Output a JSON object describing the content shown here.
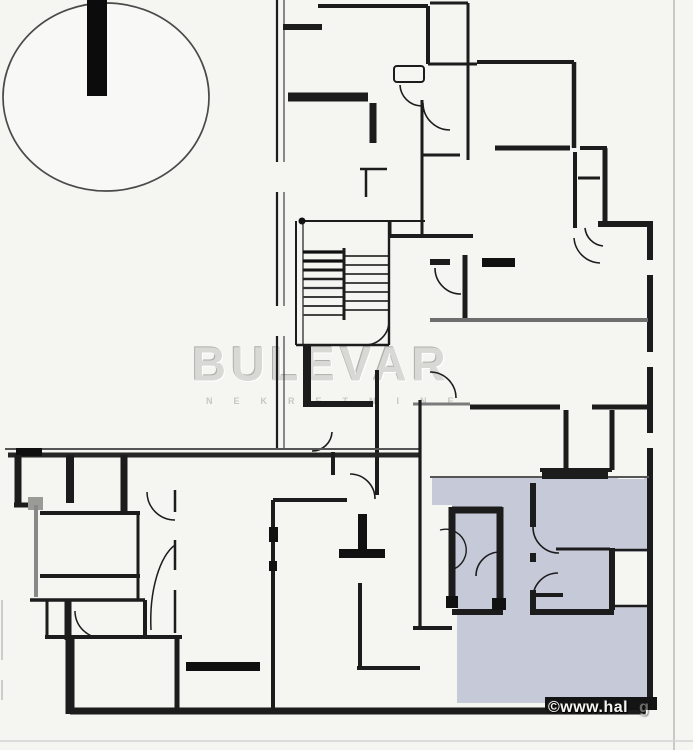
{
  "image": {
    "description": "Building floor plan with one apartment highlighted",
    "watermarks": {
      "brand": "BULEVAR",
      "brand_subtitle": "NEKRETNINE",
      "copyright": "©www.hal",
      "copyright_faint": "g"
    },
    "colors": {
      "background": "#f5f5f2",
      "wall": "#1c1c1c",
      "muted_wall": "#6e6e6e",
      "highlight_fill": "#c6c9d8",
      "brand_watermark": "#d8d8d4",
      "copyright_text": "#f4f4f2"
    },
    "elements": {
      "north_indicator": "circle with thick vertical bar, top-left",
      "stairwell": "hatched stair treads, center of plan",
      "highlighted_unit": "lavender apartment, bottom-right"
    }
  }
}
